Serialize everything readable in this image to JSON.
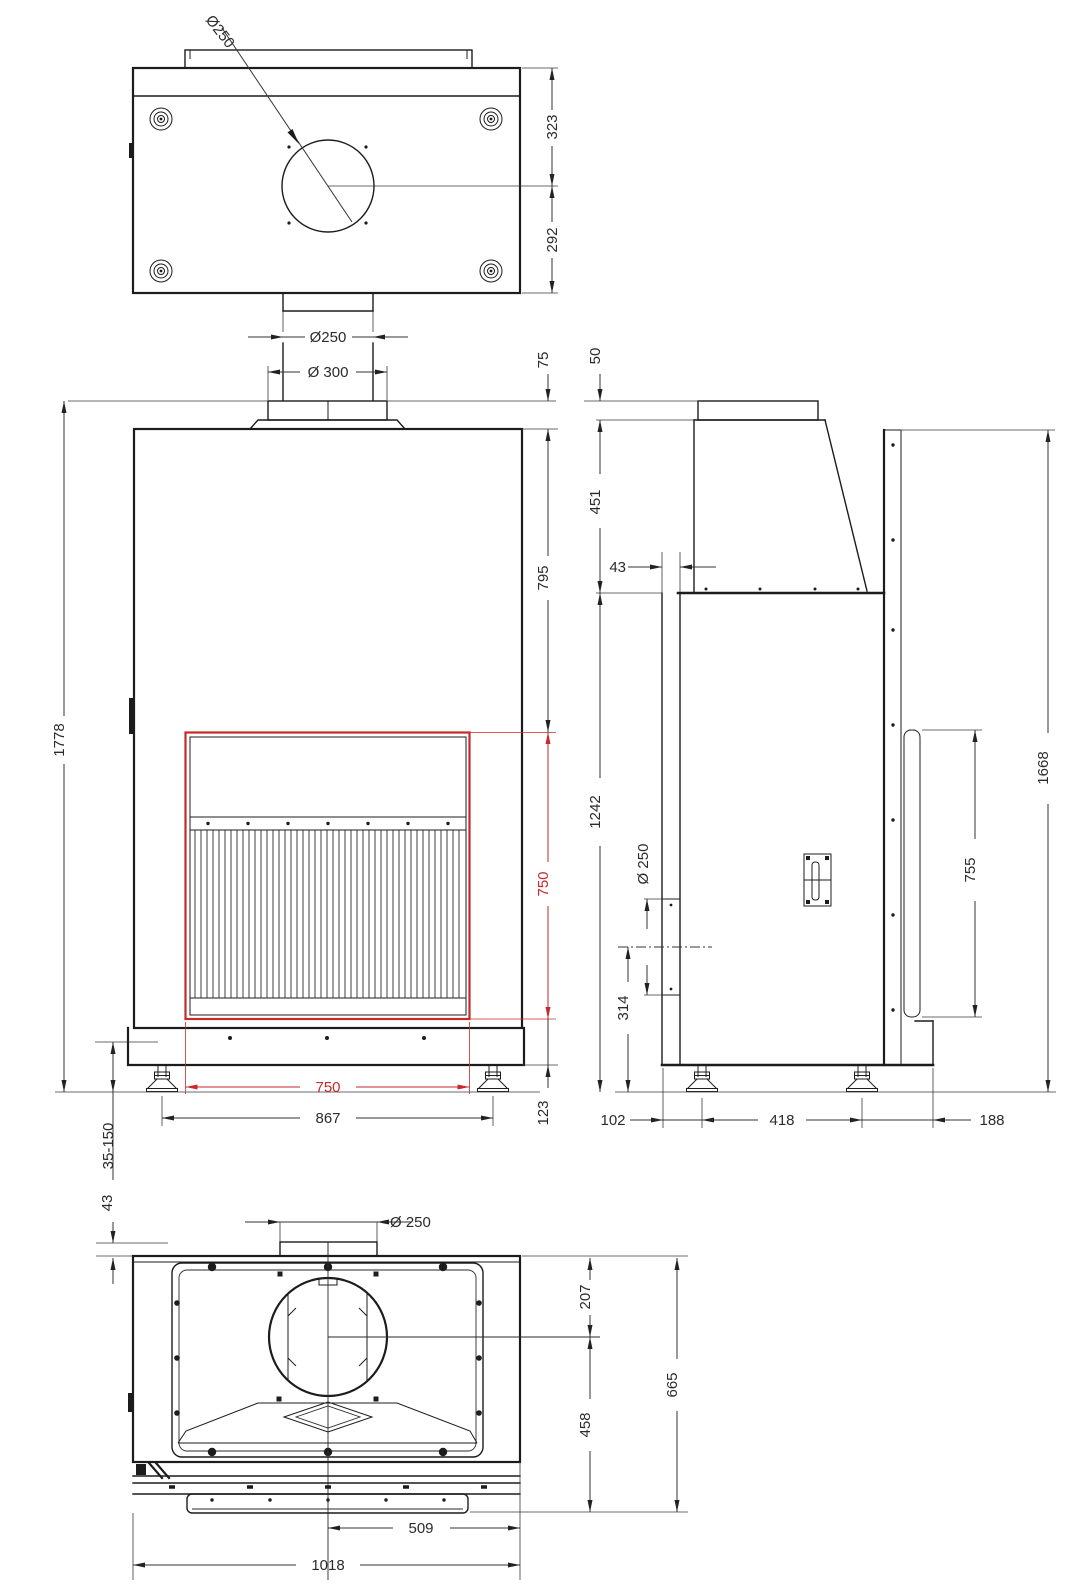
{
  "meta": {
    "drawing_type": "technical dimension drawing, fireplace insert, 4 orthographic views",
    "colors": {
      "line": "#1c1c1c",
      "highlight_red": "#c62a2a",
      "background": "#ffffff"
    }
  },
  "labels": {
    "top": {
      "flue_leader": "Ø250",
      "depth_back": "323",
      "depth_front": "292",
      "spigot": "Ø250"
    },
    "front": {
      "collar": "Ø 300",
      "collar_height": "75",
      "top_to_opening": "795",
      "total_height": "1778",
      "opening_height": "750",
      "opening_width": "750",
      "feet_span": "867",
      "base_height": "123",
      "feet_range": "35-150",
      "wall_gap": "43"
    },
    "side": {
      "collar_height": "50",
      "hood_height": "451",
      "front_offset": "43",
      "hood_to_floor": "1242",
      "rear_flue": "Ø 250",
      "flue_center_height": "314",
      "shield_height": "755",
      "total_height": "1668",
      "front_foot": "102",
      "feet_span": "418",
      "rear_foot": "188"
    },
    "bottom": {
      "spigot": "Ø 250",
      "back_gap": "43",
      "back_to_center": "207",
      "center_to_front": "458",
      "depth": "665",
      "center_to_side": "509",
      "width": "1018"
    }
  }
}
